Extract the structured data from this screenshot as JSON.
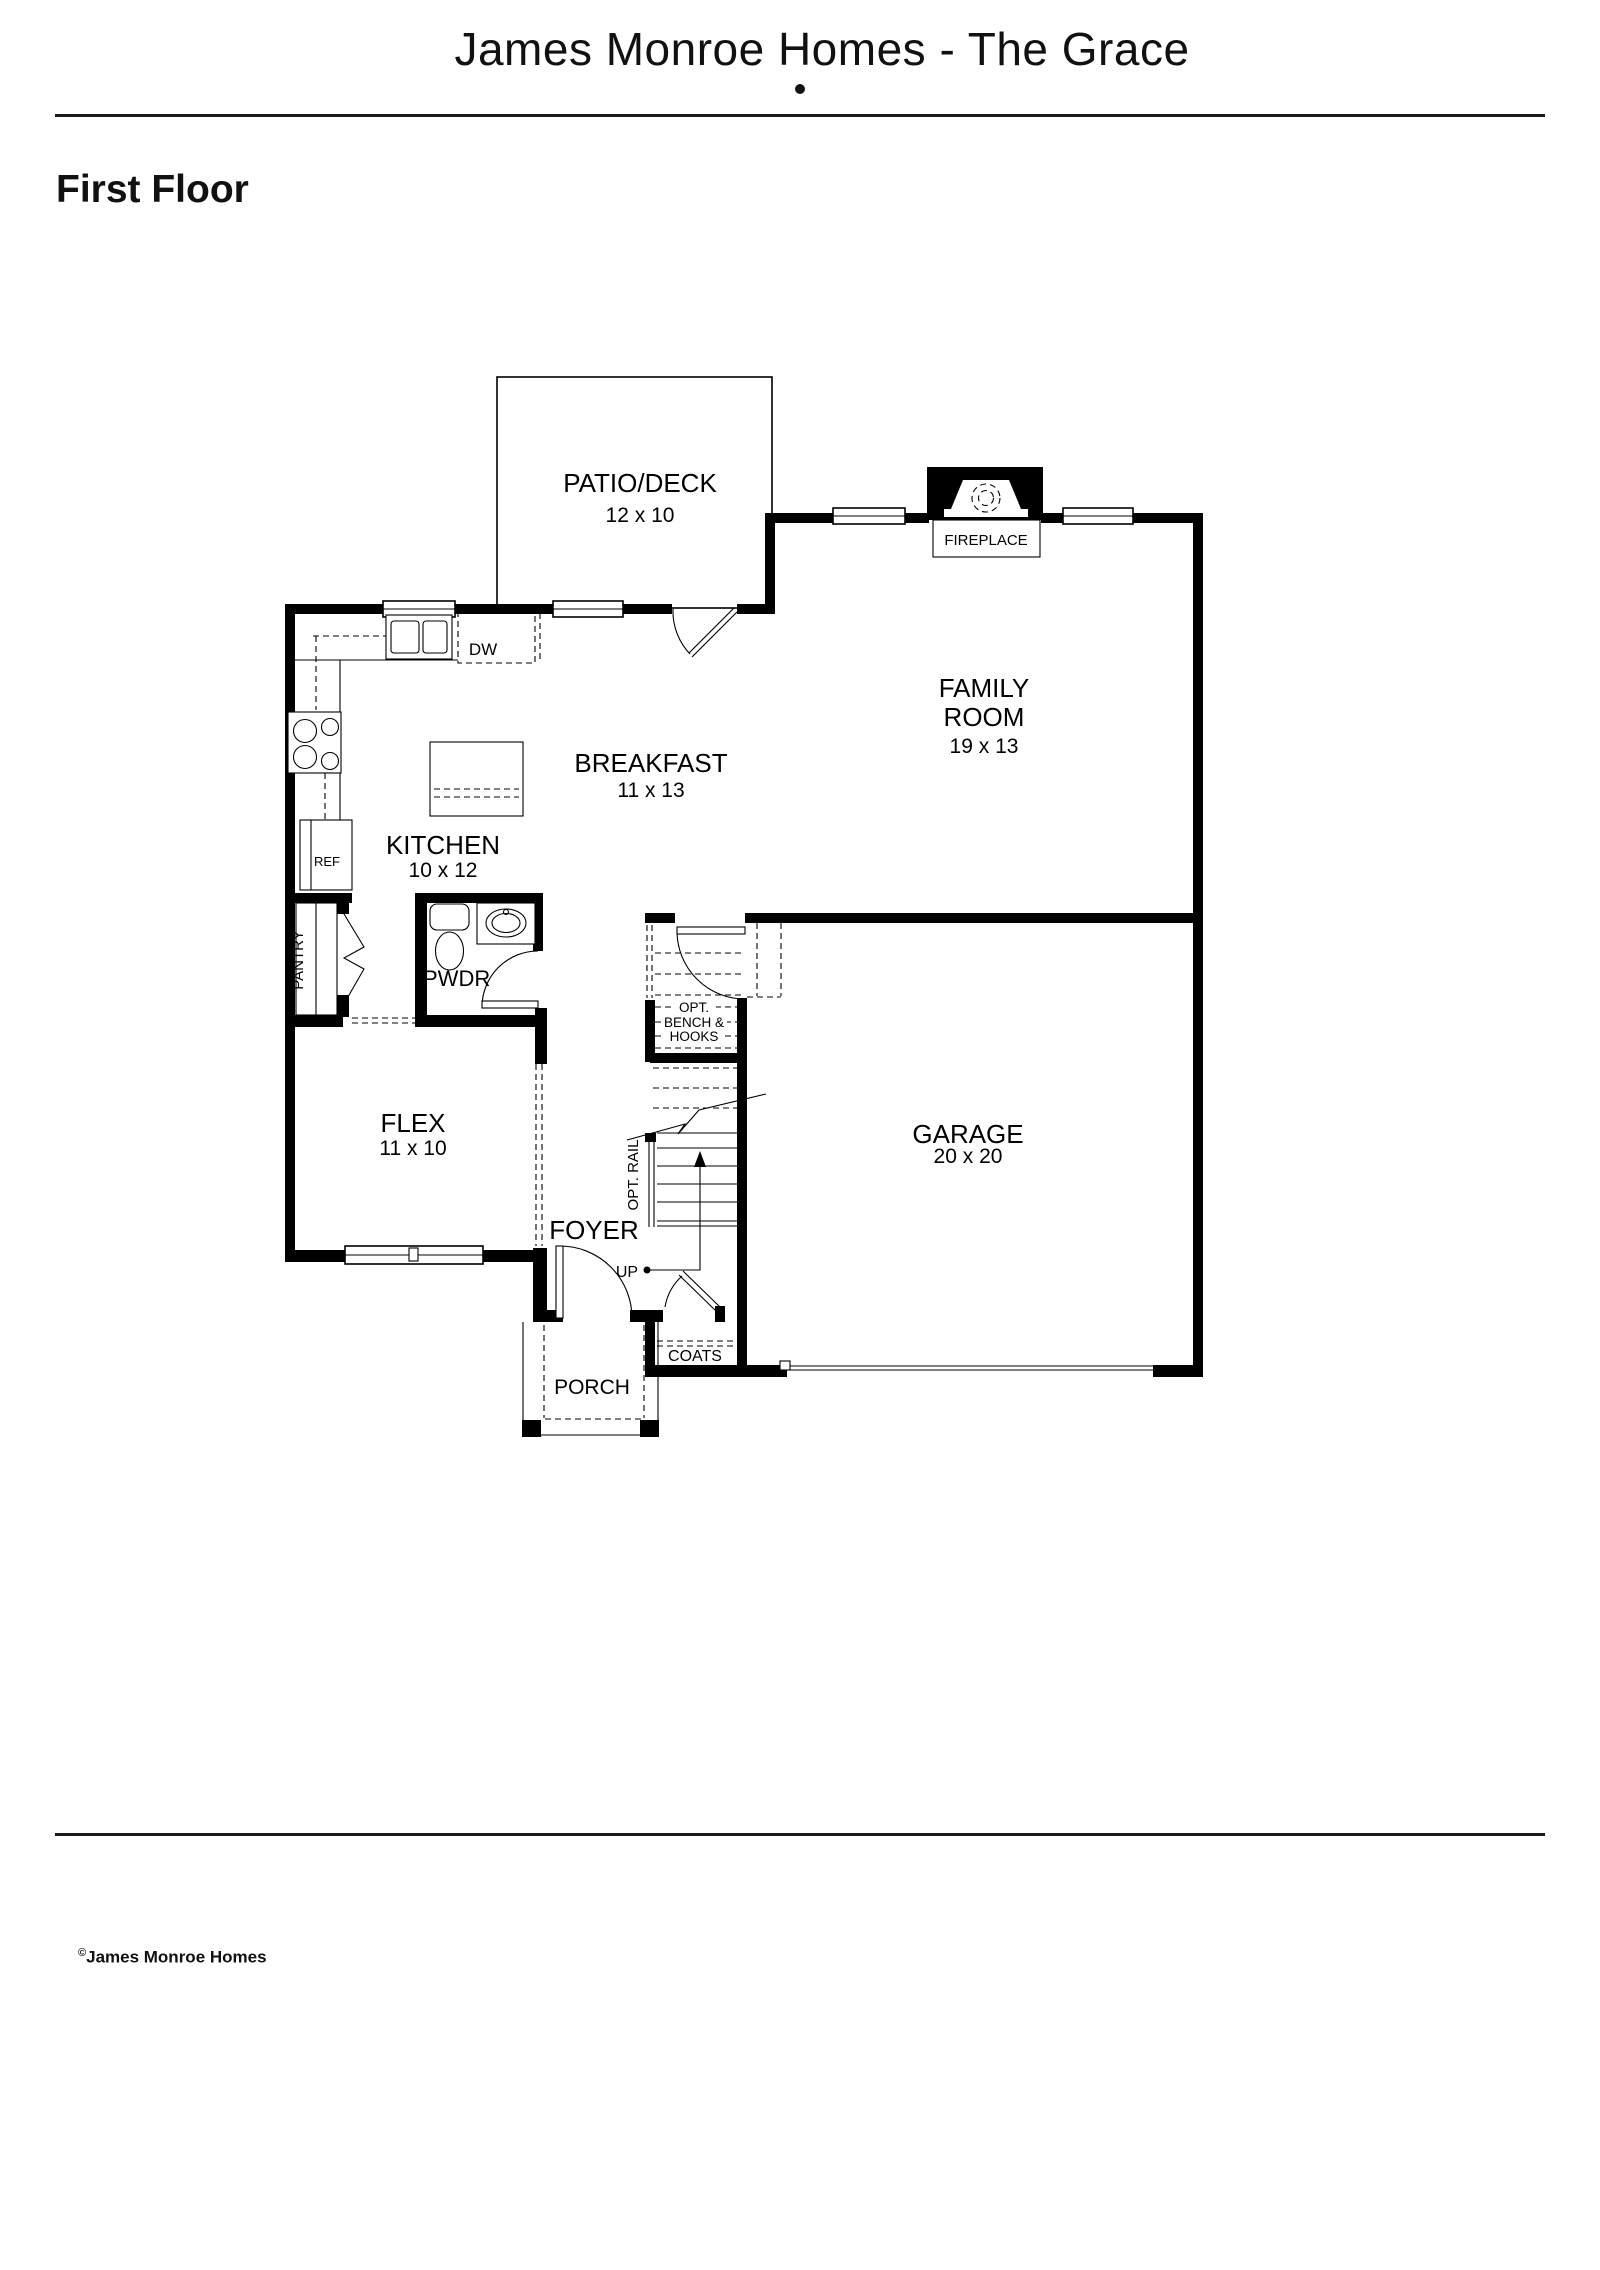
{
  "header": {
    "title": "James Monroe Homes - The Grace",
    "separator_dot": "•",
    "section": "First Floor"
  },
  "footer": {
    "copyright_symbol": "©",
    "brand": "James Monroe Homes"
  },
  "plan": {
    "rooms": {
      "patio": {
        "name": "PATIO/DECK",
        "dims": "12 x 10"
      },
      "family_room": {
        "name_line1": "FAMILY",
        "name_line2": "ROOM",
        "dims": "19 x 13"
      },
      "breakfast": {
        "name": "BREAKFAST",
        "dims": "11 x 13"
      },
      "kitchen": {
        "name": "KITCHEN",
        "dims": "10 x 12"
      },
      "flex": {
        "name": "FLEX",
        "dims": "11 x 10"
      },
      "garage": {
        "name": "GARAGE",
        "dims": "20 x 20"
      },
      "foyer": {
        "name": "FOYER"
      },
      "porch": {
        "name": "PORCH"
      },
      "powder_room": {
        "name": "PWDR"
      },
      "pantry": {
        "name": "PANTRY"
      }
    },
    "annotations": {
      "fireplace": "FIREPLACE",
      "dishwasher": "DW",
      "refrigerator": "REF",
      "coats": "COATS",
      "stairs_up": "UP",
      "opt_rail": "OPT. RAIL",
      "opt_bench_line1": "OPT.",
      "opt_bench_line2": "BENCH &",
      "opt_bench_line3": "HOOKS"
    }
  },
  "colors": {
    "ink": "#000000",
    "paper": "#ffffff"
  }
}
